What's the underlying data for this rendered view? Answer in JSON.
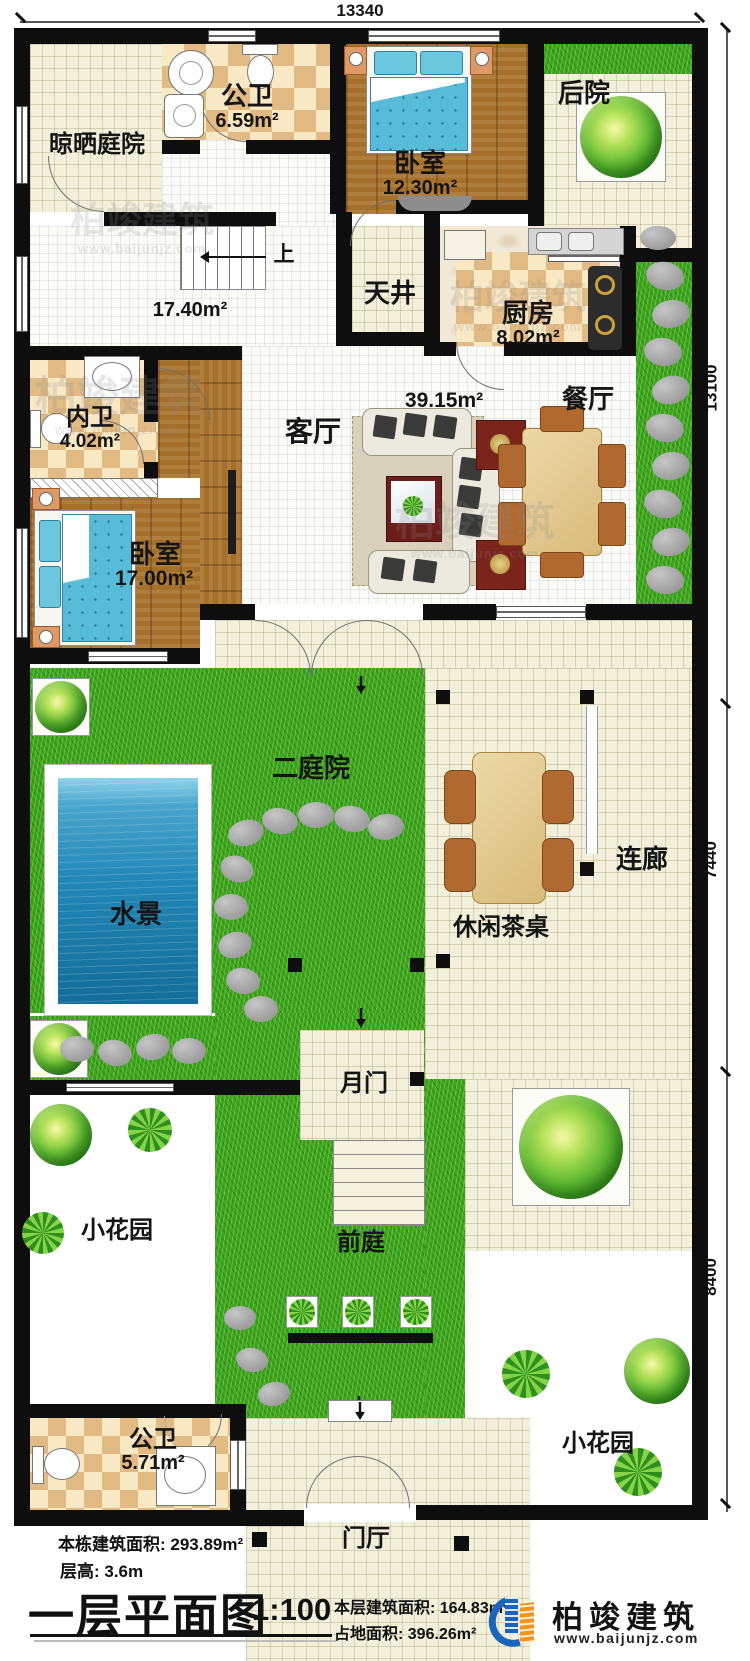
{
  "plan": {
    "dim_top": "13340",
    "dim_right_upper": "13100",
    "dim_right_middle": "7440",
    "dim_right_lower": "8400"
  },
  "rooms": {
    "liangshai": {
      "label": "晾晒庭院"
    },
    "gongwei_top": {
      "label": "公卫",
      "area": "6.59m²"
    },
    "woshi_top": {
      "label": "卧室",
      "area": "12.30m²"
    },
    "houyuan": {
      "label": "后院"
    },
    "stairs": {
      "label": "上",
      "area": "17.40m²"
    },
    "tianjing": {
      "label": "天井"
    },
    "chufang": {
      "label": "厨房",
      "area": "8.02m²"
    },
    "neiwei": {
      "label": "内卫",
      "area": "4.02m²"
    },
    "keting": {
      "label": "客厅",
      "area": "39.15m²"
    },
    "canting": {
      "label": "餐厅"
    },
    "woshi_left": {
      "label": "卧室",
      "area": "17.00m²"
    },
    "ertingyuan": {
      "label": "二庭院"
    },
    "shuijing": {
      "label": "水景"
    },
    "lianlang": {
      "label": "连廊"
    },
    "chazhuo": {
      "label": "休闲茶桌"
    },
    "yuemen": {
      "label": "月门"
    },
    "qianting": {
      "label": "前庭"
    },
    "huayuan_left": {
      "label": "小花园"
    },
    "huayuan_right": {
      "label": "小花园"
    },
    "gongwei_bottom": {
      "label": "公卫",
      "area": "5.71m²"
    },
    "menting": {
      "label": "门厅"
    }
  },
  "titleblock": {
    "building_area_label": "本栋建筑面积: 293.89m²",
    "floor_height_label": "层高: 3.6m",
    "plan_title": "一层平面图",
    "scale": "1:100",
    "floor_area_label": "本层建筑面积: 164.83m²",
    "land_area_label": "占地面积: 396.26m²"
  },
  "branding": {
    "company": "柏竣建筑",
    "website": "www.baijunjz.com"
  },
  "watermark": {
    "text": "柏竣建筑",
    "site": "www.baijunjz.com"
  },
  "colors": {
    "wall": "#0e0e0e",
    "grass": "#3da51f",
    "water": "#2387b7",
    "wood": "#a5702c",
    "tile_cream": "#f2efdb",
    "checker": "#e2ba84",
    "logo_blue": "#1b66bb",
    "logo_orange": "#f5941d"
  }
}
